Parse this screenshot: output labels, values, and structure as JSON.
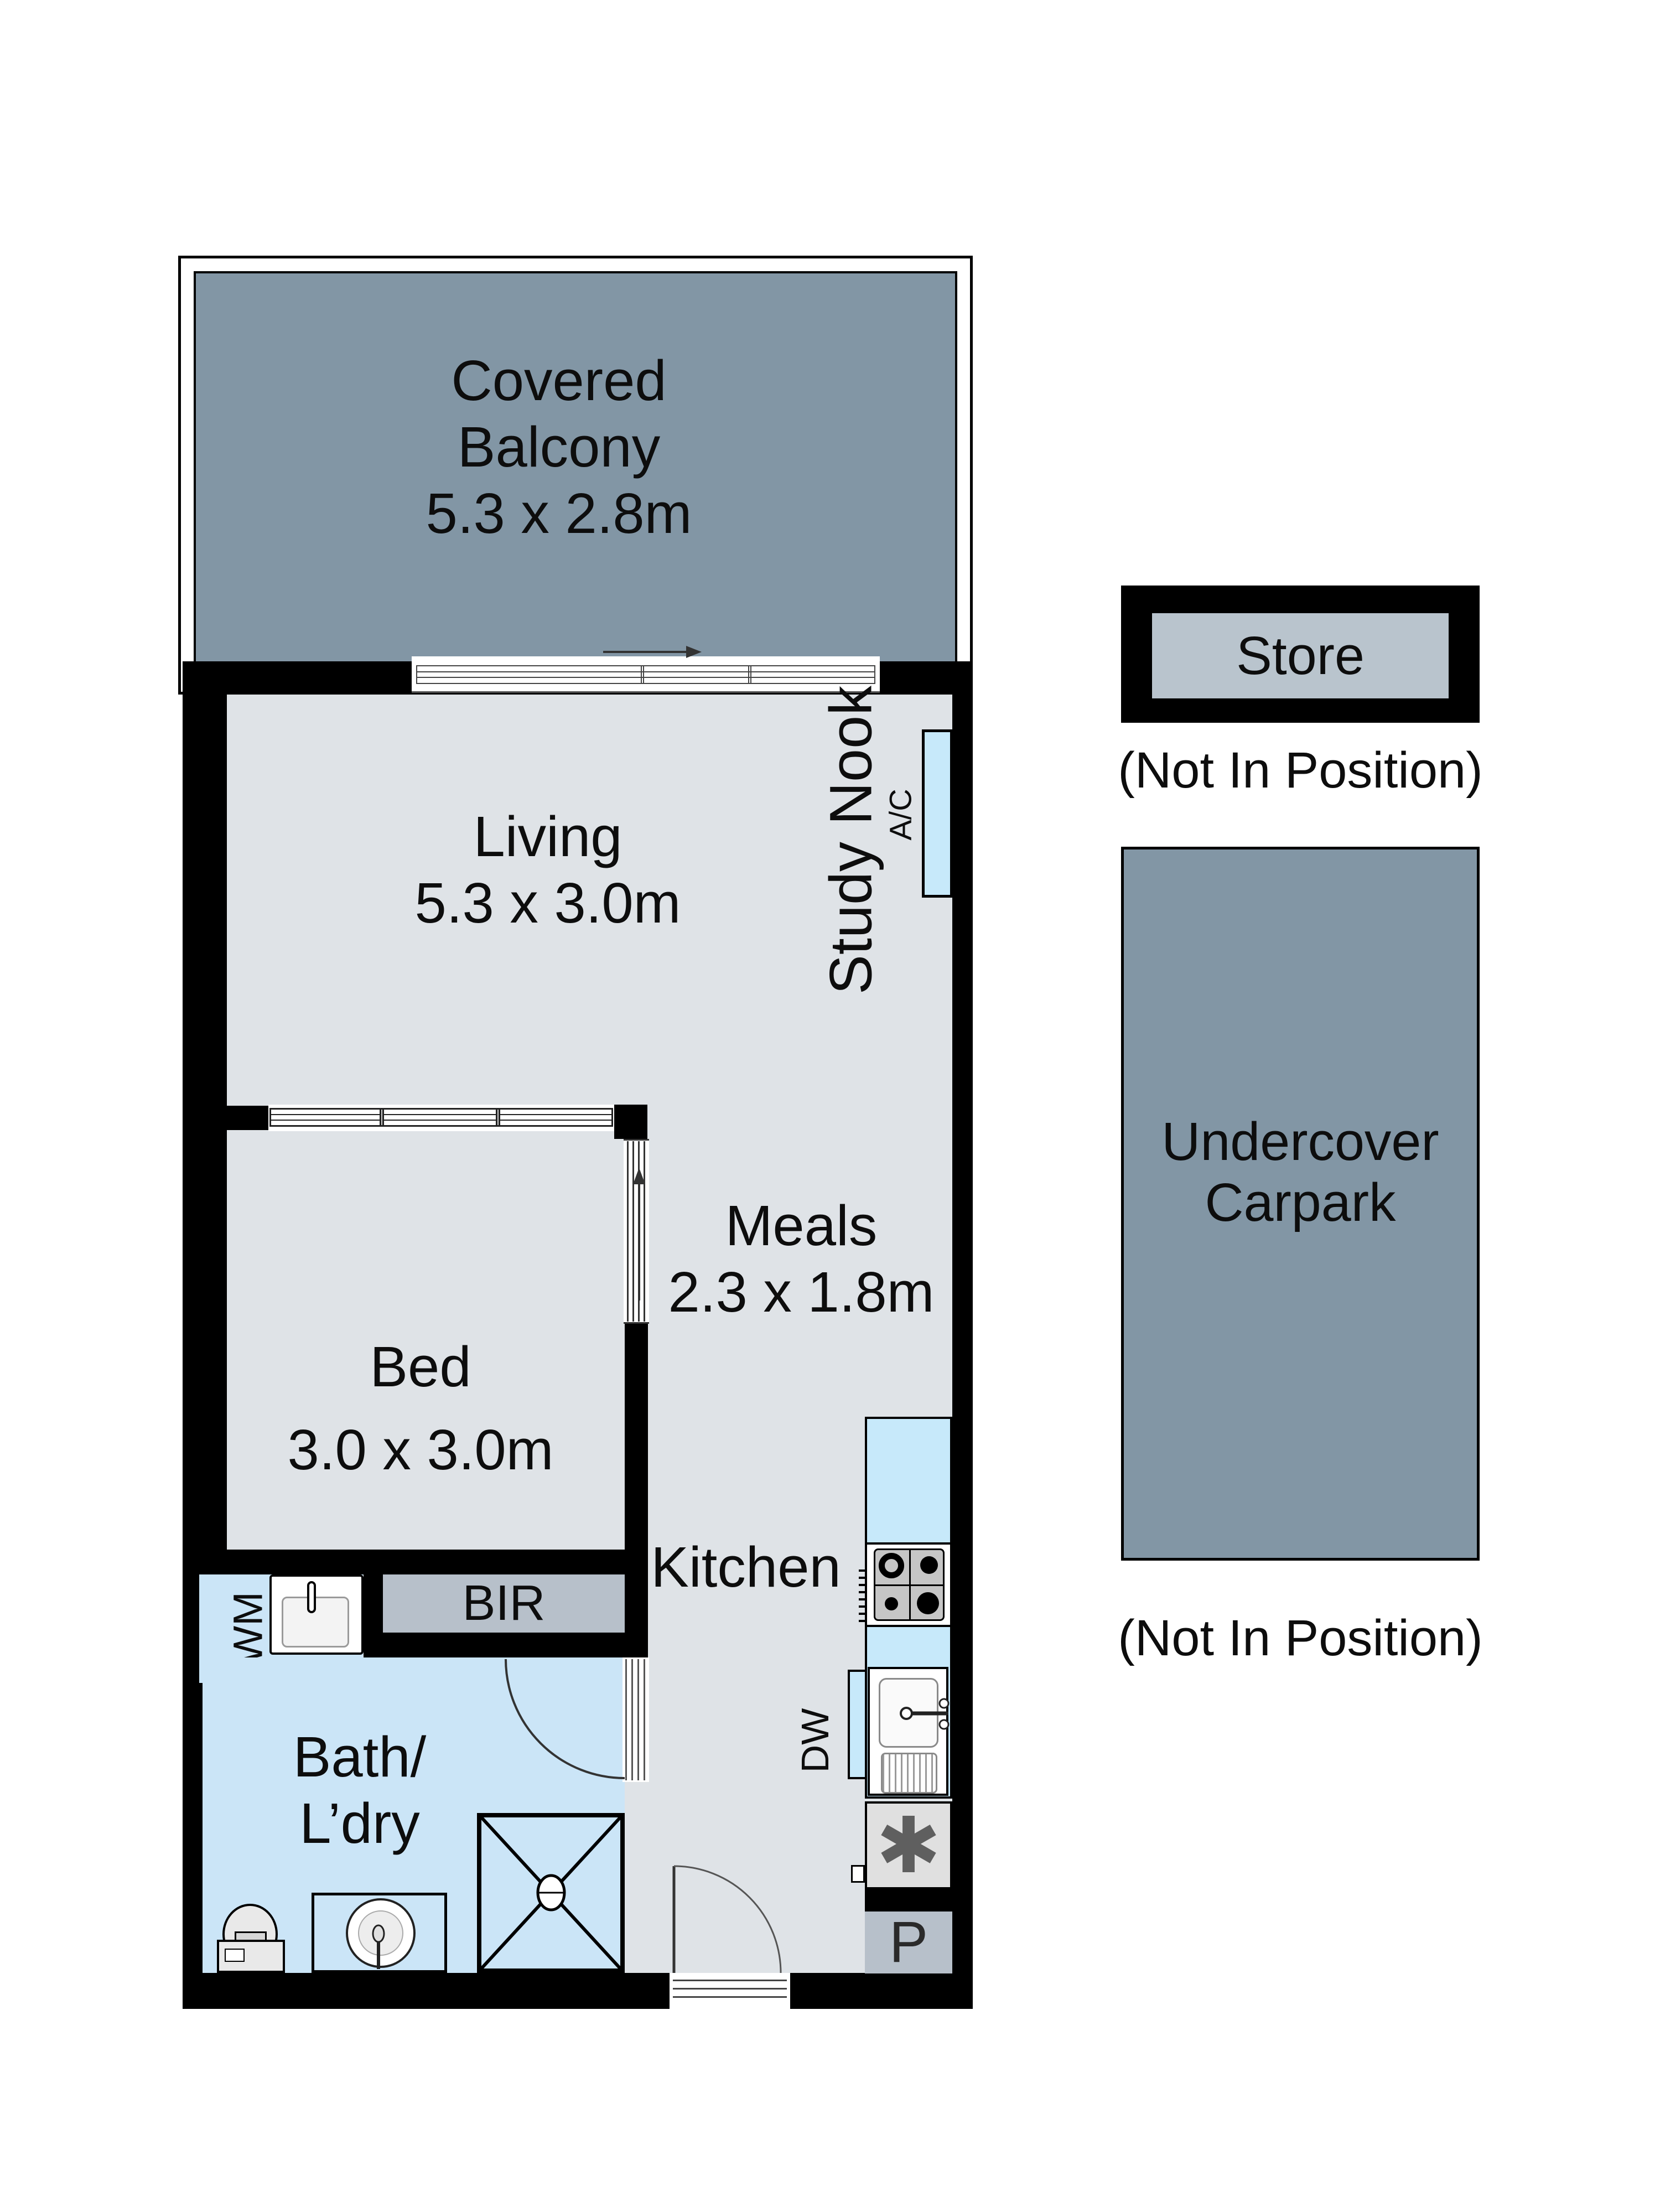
{
  "colors": {
    "wall": "#000000",
    "zone": "#8296a5",
    "floor": "#dfe3e7",
    "bath": "#cbe5f7",
    "fixture": "#c7e9fa",
    "storage": "#b7c0ca",
    "storefill": "#b9c4cd",
    "appliance": "#c6c6c6",
    "ink": "#0d0d0d"
  },
  "plan": {
    "balcony": {
      "line1": "Covered",
      "line2": "Balcony",
      "dims": "5.3 x 2.8m"
    },
    "living": {
      "name": "Living",
      "dims": "5.3 x 3.0m"
    },
    "study_nook": {
      "name": "Study Nook"
    },
    "ac": {
      "label": "A/C"
    },
    "bed": {
      "name": "Bed",
      "dims": "3.0 x 3.0m"
    },
    "meals": {
      "name": "Meals",
      "dims": "2.3 x 1.8m"
    },
    "bir": {
      "label": "BIR"
    },
    "wm": {
      "label": "WM"
    },
    "bath": {
      "line1": "Bath/",
      "line2": "L’dry"
    },
    "kitchen": {
      "name": "Kitchen"
    },
    "dw": {
      "label": "DW"
    },
    "hot_water": {
      "symbol": "✱"
    },
    "pantry": {
      "label": "P"
    }
  },
  "annex": {
    "store": {
      "label": "Store",
      "note": "(Not In Position)"
    },
    "carpark": {
      "line1": "Undercover",
      "line2": "Carpark",
      "note": "(Not In Position)"
    }
  }
}
